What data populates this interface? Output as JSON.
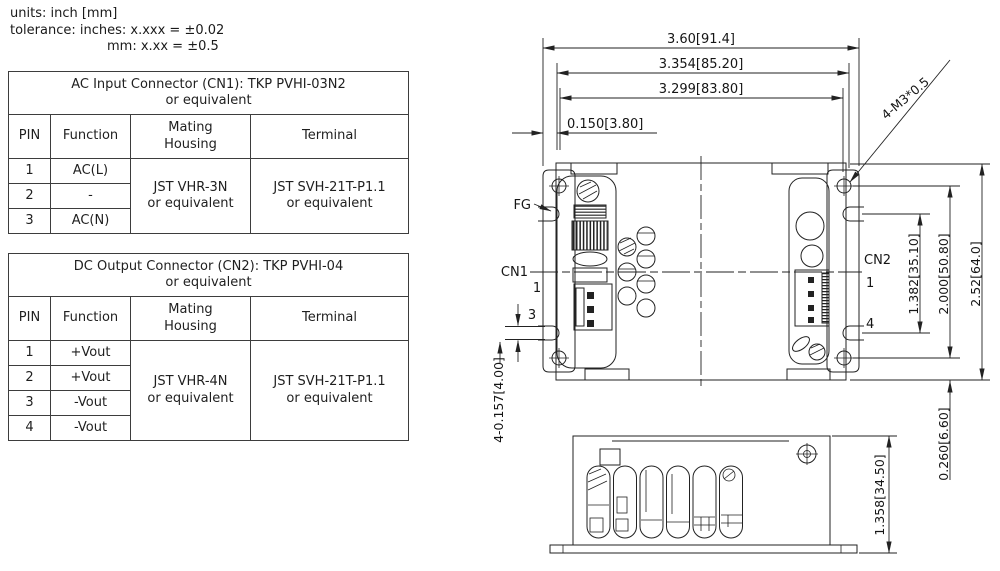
{
  "header": {
    "line1": "units: inch [mm]",
    "line2": "tolerance: inches: x.xxx = ±0.02",
    "line3": "mm: x.xx = ±0.5"
  },
  "tables": [
    {
      "title": "AC Input Connector (CN1): TKP PVHI-03N2\nor equivalent",
      "col_pin": "PIN",
      "col_function": "Function",
      "col_housing": "Mating\nHousing",
      "col_terminal": "Terminal",
      "rows": [
        {
          "pin": "1",
          "fn": "AC(L)"
        },
        {
          "pin": "2",
          "fn": "-"
        },
        {
          "pin": "3",
          "fn": "AC(N)"
        }
      ],
      "housing": "JST VHR-3N\nor equivalent",
      "terminal": "JST SVH-21T-P1.1\nor equivalent"
    },
    {
      "title": "DC Output Connector (CN2): TKP PVHI-04\nor equivalent",
      "col_pin": "PIN",
      "col_function": "Function",
      "col_housing": "Mating\nHousing",
      "col_terminal": "Terminal",
      "rows": [
        {
          "pin": "1",
          "fn": "+Vout"
        },
        {
          "pin": "2",
          "fn": "+Vout"
        },
        {
          "pin": "3",
          "fn": "-Vout"
        },
        {
          "pin": "4",
          "fn": "-Vout"
        }
      ],
      "housing": "JST VHR-4N\nor equivalent",
      "terminal": "JST SVH-21T-P1.1\nor equivalent"
    }
  ],
  "drawing": {
    "top_view": {
      "dim_overall_width": "3.60[91.4]",
      "dim_mounting_width": "3.354[85.20]",
      "dim_slot_width": "3.299[83.80]",
      "dim_edge_offset": "0.150[3.80]",
      "screw_note": "4-M3*0.5",
      "fg_label": "FG",
      "cn1_label": "CN1",
      "cn1_pin_first": "1",
      "cn1_pin_last": "3",
      "cn2_label": "CN2",
      "cn2_pin_first": "1",
      "cn2_pin_last": "4",
      "dim_slot_spacing": "1.382[35.10]",
      "dim_screw_spacing": "2.000[50.80]",
      "dim_overall_depth": "2.52[64.0]",
      "dim_bottom_offset": "0.260[6.60]",
      "slot_note": "4-0.157[4.00]"
    },
    "side_view": {
      "dim_height": "1.358[34.50]"
    }
  }
}
